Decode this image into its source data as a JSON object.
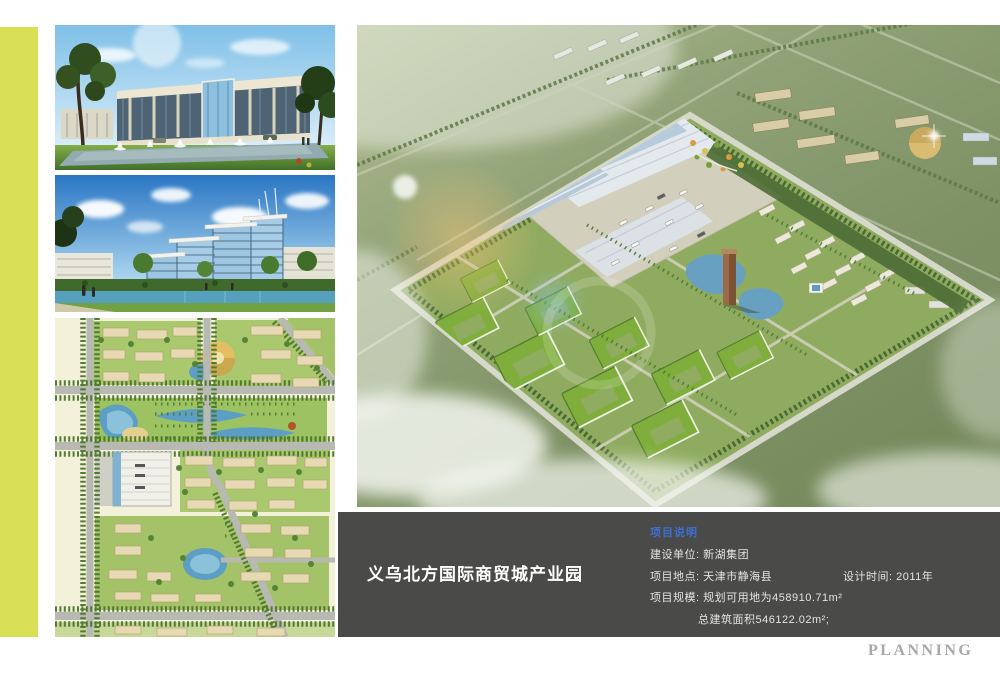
{
  "info_bar": {
    "title": "义乌北方国际商贸城产业园",
    "heading": "项目说明",
    "client": "建设单位: 新湖集团",
    "location": "项目地点: 天津市静海县",
    "design_time": "设计时间: 2011年",
    "scale_line1": "项目规模: 规划可用地为458910.71m²",
    "scale_line2": "总建筑面积546122.02m²;"
  },
  "footer": {
    "label": "PLANNING"
  },
  "colors": {
    "accent_stripe": "#d9e056",
    "info_bar_bg": "#4a4a48",
    "heading_blue": "#3e6fd0",
    "footer_gray": "#a8a8a8"
  }
}
